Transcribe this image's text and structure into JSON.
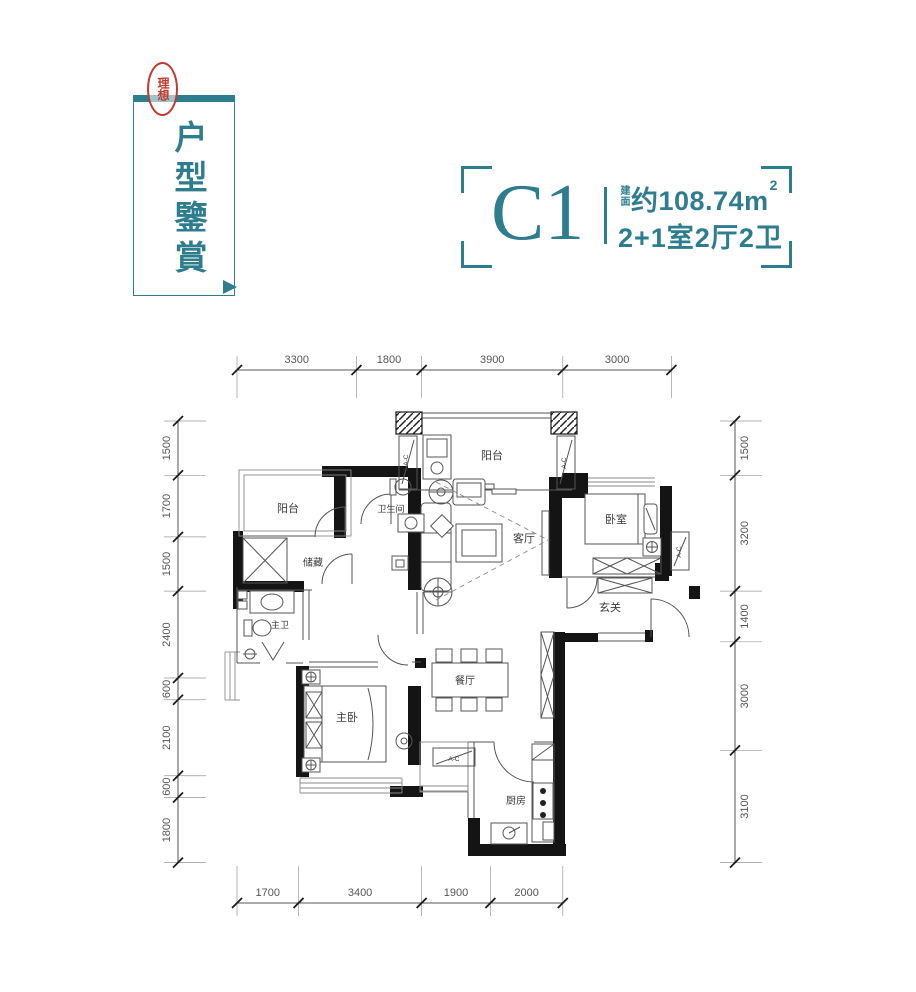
{
  "colors": {
    "accent": "#2e7d8e",
    "seal_red": "#c0392b",
    "wall": "#141414"
  },
  "badge": {
    "vertical_title": "户型鑒賞",
    "seal": "理想"
  },
  "title": {
    "unit": "C1",
    "area_label": "建面",
    "area_value": "约108.74m",
    "area_sup": "2",
    "layout": "2+1室2厅2卫"
  },
  "plan": {
    "rooms": {
      "balcony_top": "阳台",
      "balcony_left": "阳台",
      "bathroom": "卫生间",
      "living": "客厅",
      "bedroom": "卧室",
      "storage": "储藏",
      "entry": "玄关",
      "master_bath": "主卫",
      "dining": "餐厅",
      "master_bed": "主卧",
      "kitchen": "厨房"
    },
    "ac_labels": [
      "2-A-C",
      "A-C",
      "A-C",
      "A-C"
    ],
    "dims": {
      "top": [
        3300,
        1800,
        3900,
        3000
      ],
      "bottom": [
        1700,
        3400,
        1900,
        2000
      ],
      "left": [
        1500,
        1700,
        1500,
        2400,
        600,
        2100,
        600,
        1800
      ],
      "right": [
        1500,
        3200,
        1400,
        3000,
        3100
      ]
    }
  }
}
